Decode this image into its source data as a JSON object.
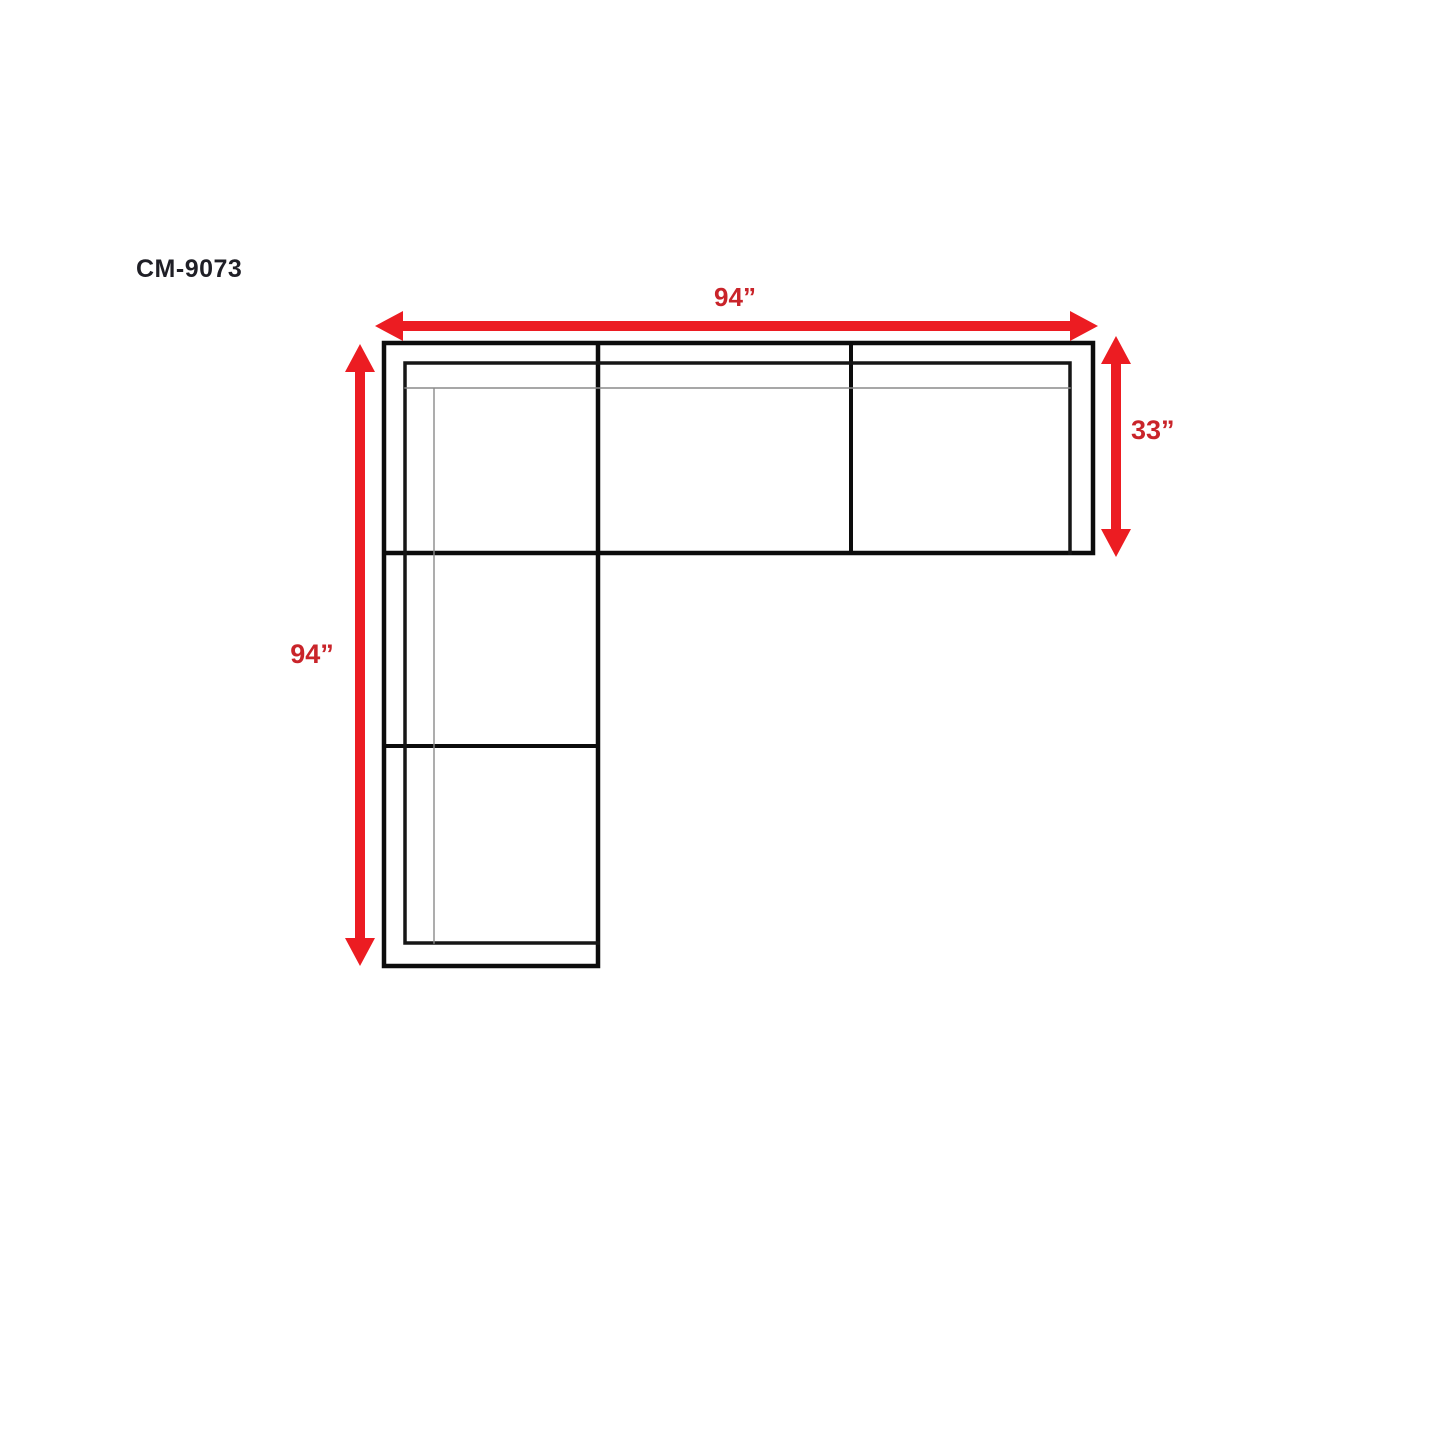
{
  "page": {
    "background": "#ffffff"
  },
  "title": {
    "text": "CM-9073"
  },
  "diagram": {
    "type": "sectional-sofa-top-view-dimension-drawing",
    "shape": "L-shaped sectional, three seat sections across top, corner section, two seat sections down left side",
    "dimensions": {
      "top_width": "94”",
      "right_depth": "33”",
      "left_length": "94”"
    },
    "colors": {
      "arrow_red": "#ec1c22",
      "dimension_text_red": "#c9242a",
      "outline_black": "#0c0c0c",
      "inner_line_black": "#161616",
      "thin_line_gray": "#8a8a8a",
      "title_color": "#1f1f26"
    }
  }
}
